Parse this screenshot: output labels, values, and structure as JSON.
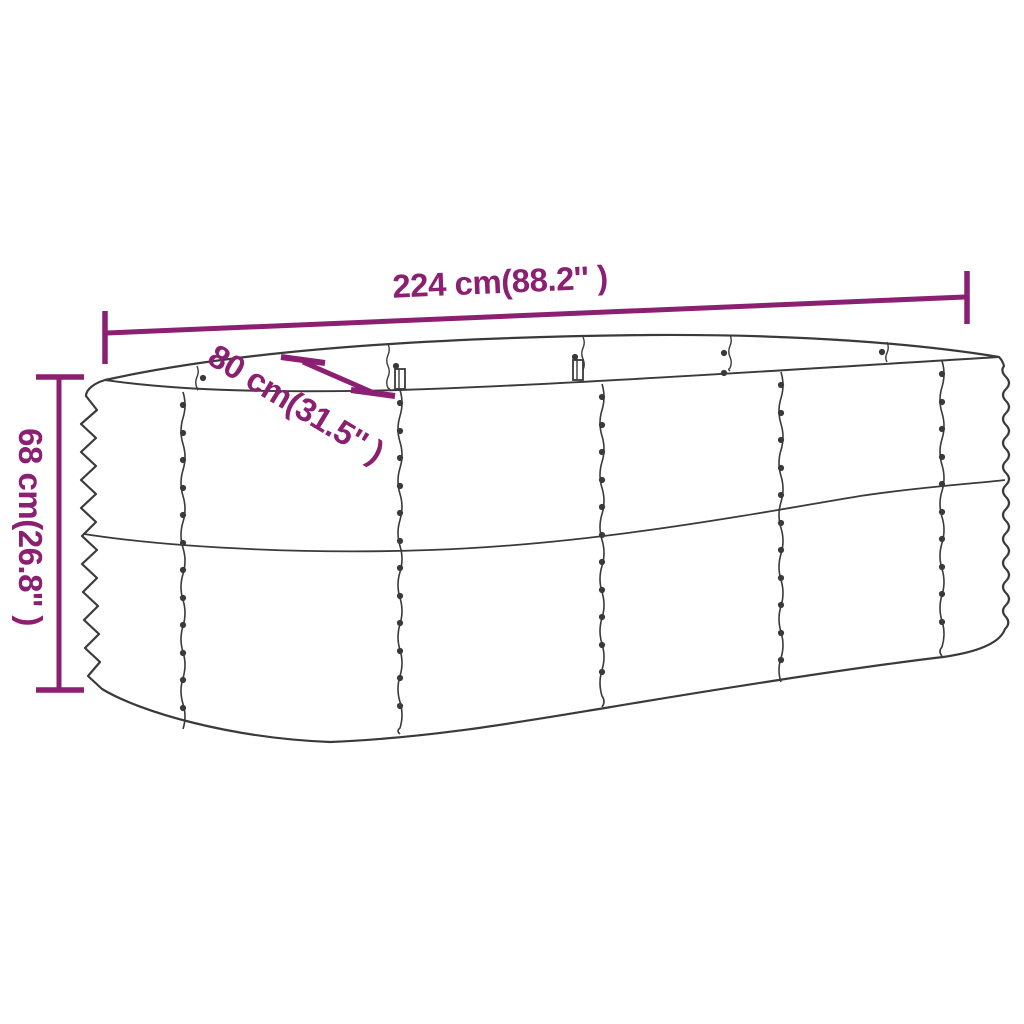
{
  "colors": {
    "dimension_accent": "#8B1F71",
    "drawing_line": "#3A3A3A",
    "background": "#FFFFFF"
  },
  "dimension_labels": {
    "length": "224 cm(88.2'' )",
    "width": "80 cm(31.5'' )",
    "height": "68 cm(26.8'' )"
  }
}
